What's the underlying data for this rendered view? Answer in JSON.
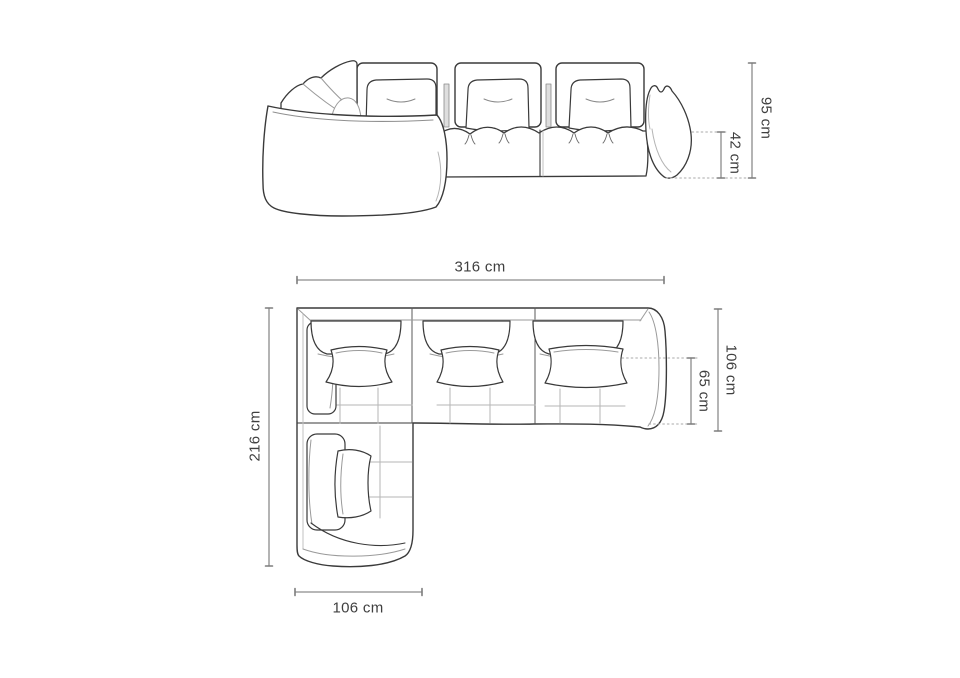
{
  "page": {
    "background": "#ffffff"
  },
  "styles": {
    "outline_color": "#3a3a3a",
    "detail_line_color": "#9a9a9a",
    "faint_line_color": "#bcbcbc",
    "dimension_line_color": "#8c8c8c",
    "dotted_line_color": "#a9a9a9",
    "label_color": "#3f3f3f"
  },
  "front_view": {
    "dimensions": {
      "total_height": {
        "label": "95 cm"
      },
      "seat_height": {
        "label": "42 cm"
      }
    }
  },
  "top_view": {
    "dimensions": {
      "total_width": {
        "label": "316 cm"
      },
      "total_depth": {
        "label": "106 cm"
      },
      "seat_depth": {
        "label": "65 cm"
      },
      "chaise_length": {
        "label": "216 cm"
      },
      "chaise_width": {
        "label": "106 cm"
      }
    }
  }
}
